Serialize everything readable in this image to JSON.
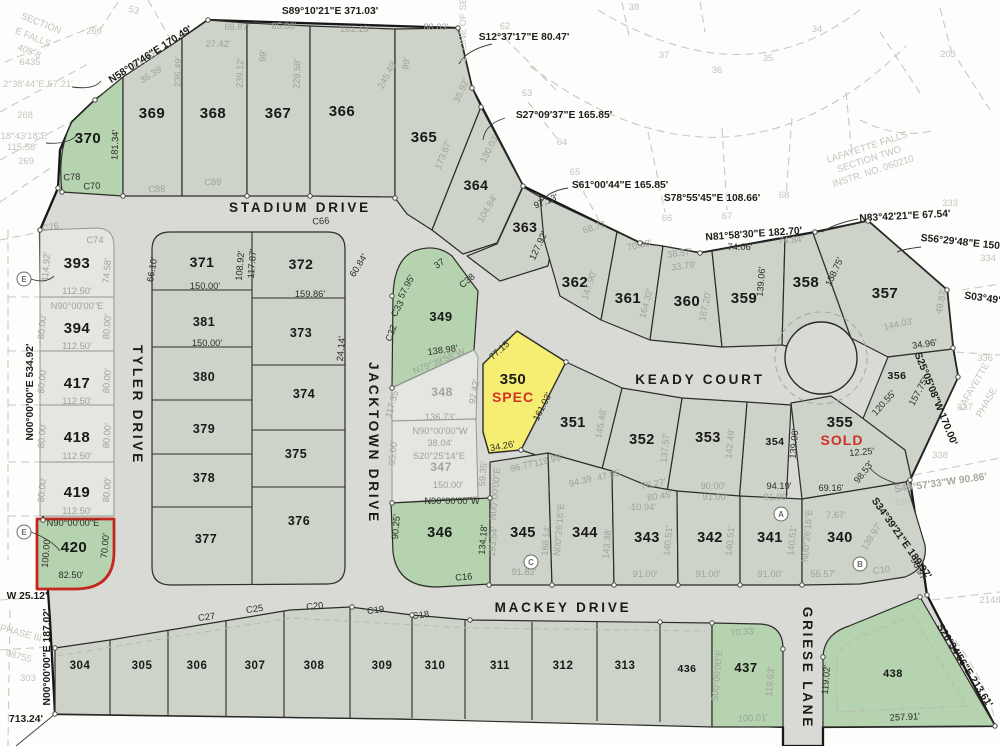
{
  "streets": [
    {
      "name": "STADIUM DRIVE"
    },
    {
      "name": "TYLER DRIVE"
    },
    {
      "name": "JACKTOWN DRIVE"
    },
    {
      "name": "KEADY COURT"
    },
    {
      "name": "MACKEY DRIVE"
    },
    {
      "name": "GRIESE LANE"
    }
  ],
  "lots": [
    {
      "number": "370"
    },
    {
      "number": "369"
    },
    {
      "number": "368"
    },
    {
      "number": "367"
    },
    {
      "number": "366"
    },
    {
      "number": "365"
    },
    {
      "number": "364"
    },
    {
      "number": "363"
    },
    {
      "number": "362"
    },
    {
      "number": "361"
    },
    {
      "number": "360"
    },
    {
      "number": "359"
    },
    {
      "number": "358"
    },
    {
      "number": "357"
    },
    {
      "number": "356"
    },
    {
      "number": "355",
      "status": "SOLD"
    },
    {
      "number": "354"
    },
    {
      "number": "353"
    },
    {
      "number": "352"
    },
    {
      "number": "351"
    },
    {
      "number": "350",
      "status": "SPEC"
    },
    {
      "number": "349"
    },
    {
      "number": "348"
    },
    {
      "number": "347"
    },
    {
      "number": "346"
    },
    {
      "number": "345"
    },
    {
      "number": "344"
    },
    {
      "number": "343"
    },
    {
      "number": "342"
    },
    {
      "number": "341"
    },
    {
      "number": "340"
    },
    {
      "number": "393"
    },
    {
      "number": "394"
    },
    {
      "number": "417"
    },
    {
      "number": "418"
    },
    {
      "number": "419"
    },
    {
      "number": "420"
    },
    {
      "number": "371"
    },
    {
      "number": "381"
    },
    {
      "number": "380"
    },
    {
      "number": "379"
    },
    {
      "number": "378"
    },
    {
      "number": "377"
    },
    {
      "number": "372"
    },
    {
      "number": "373"
    },
    {
      "number": "374"
    },
    {
      "number": "375"
    },
    {
      "number": "376"
    },
    {
      "number": "304"
    },
    {
      "number": "305"
    },
    {
      "number": "306"
    },
    {
      "number": "307"
    },
    {
      "number": "308"
    },
    {
      "number": "309"
    },
    {
      "number": "310"
    },
    {
      "number": "311"
    },
    {
      "number": "312"
    },
    {
      "number": "313"
    },
    {
      "number": "436"
    },
    {
      "number": "437"
    },
    {
      "number": "438"
    }
  ],
  "dimensions": [
    "181.34'",
    "108.68",
    "36.39'",
    "236.49'",
    "66.87'",
    "27.42'",
    "85.00'",
    "239.12'",
    "99'",
    "229.58'",
    "181.13'",
    "88.03'",
    "245.49'",
    "99'",
    "173.67'",
    "35.92'",
    "130.03'",
    "104.84'",
    "97.13'",
    "127.92'",
    "68.72",
    "70.08'",
    "38.57'",
    "33.79'",
    "147.90'",
    "164.32'",
    "167.20'",
    "74.06'",
    "74.84'",
    "139.06'",
    "138.75'",
    "144.03'",
    "49.87'",
    "34.96'",
    "157.75'",
    "120.55'",
    "12.25'",
    "98.53'",
    "139.06'",
    "142.49'",
    "137.57'",
    "145.48'",
    "161.03'",
    "77.15'",
    "34.26'",
    "138.98'",
    "57.95'",
    "C33",
    "C32",
    "C38",
    "37",
    "N79°39'58\"W",
    "117.35'",
    "92.42'",
    "136.73'",
    "N90°00'00\"W",
    "38.04'",
    "S20°25'14\"E",
    "150.00'",
    "95.00'",
    "N90°00'00\"W",
    "90.25'",
    "134.18'",
    "C16",
    "59.35'",
    "N00°00'00\"E",
    "193.54'",
    "168.14'",
    "N00°26'16\"E",
    "143.38'",
    "140.51'",
    "140.51'",
    "140.51'",
    "N00°26'16\"E",
    "96.77'",
    "119.99'",
    "94.39",
    "47.85'",
    "78.27'",
    "80.45'",
    "-10.94'",
    "90.00'",
    "91.00'",
    "94.19'",
    "91.00'",
    "69.16'",
    "7.67'",
    "91.82'",
    "91.00'",
    "91.00'",
    "91.00'",
    "55.57'",
    "C10",
    "139.97'",
    "114.92'",
    "74.58'",
    "C74",
    "C76",
    "112.50'",
    "N90°00'00\"E",
    "80.00'",
    "80.00'",
    "112.50'",
    "80.00'",
    "80.00'",
    "112.50'",
    "80.00'",
    "80.00'",
    "112.50'",
    "80.00'",
    "80.00'",
    "112.50'",
    "N90°00'00\"E",
    "100.00'",
    "70.00'",
    "82.50'",
    "66.10'",
    "150.00'",
    "150.00'",
    "108.92'",
    "117.87'",
    "159.86'",
    "24.14'",
    "60.84'",
    "C66",
    "C70",
    "C78",
    "C88",
    "C89",
    "C27",
    "C25",
    "C20",
    "C19",
    "C18",
    "70.33'",
    "S00°00'00\"E",
    "119.63'",
    "119.02'",
    "100.01'",
    "257.91'",
    "98.97"
  ],
  "bearings": [
    "N58°07'46\"E 170.49'",
    "S89°10'21\"E 371.03'",
    "S12°37'17\"E 80.47'",
    "S27°09'37\"E 165.85'",
    "S61°00'44\"E 165.85'",
    "S78°55'45\"E 108.66'",
    "N81°58'30\"E 182.70'",
    "N83°42'21\"E 67.54'",
    "S56°29'48\"E 150",
    "S03°49'",
    "S25°05'08\"W 170.00'",
    "S49°57'33\"W 90.86'",
    "S34°39'21\"E 189.97'",
    "S26°34'56\"E 213.61'",
    "N00°00'00\"E 534.92'",
    "N00°00'00\"E 187.02'",
    "W 25.12'",
    "713.24'"
  ],
  "background_labels": [
    "SECTION",
    "E FALLS",
    "405-8",
    "6435",
    "266",
    "2°38'44\"E 57.21'",
    "268",
    "18°43'18\"E",
    "115.58'",
    "269",
    "53",
    "E. LINE OF SEC.",
    "62",
    "63",
    "64",
    "65",
    "66",
    "67",
    "68",
    "34",
    "35",
    "36",
    "37",
    "38",
    "203",
    "LAFAYETTE FALLS",
    "SECTION TWO",
    "INSTR. NO. 060210",
    "333",
    "334",
    "336",
    "337",
    "338",
    "339",
    "LAFAYETTE",
    "PHASE",
    "2148",
    "PHASE III",
    "08755",
    "303"
  ],
  "markers": [
    "E",
    "E",
    "C",
    "A",
    "B"
  ],
  "legend_colors": {
    "standard_lot": "#cdd3c9",
    "road": "#d9dad6",
    "available_green": "#b4d3ae",
    "spec_yellow": "#f6ee73",
    "pale_lot": "#e4e6e1",
    "status_text_red": "#d03126",
    "boundary_highlight_red": "#c3271e"
  }
}
